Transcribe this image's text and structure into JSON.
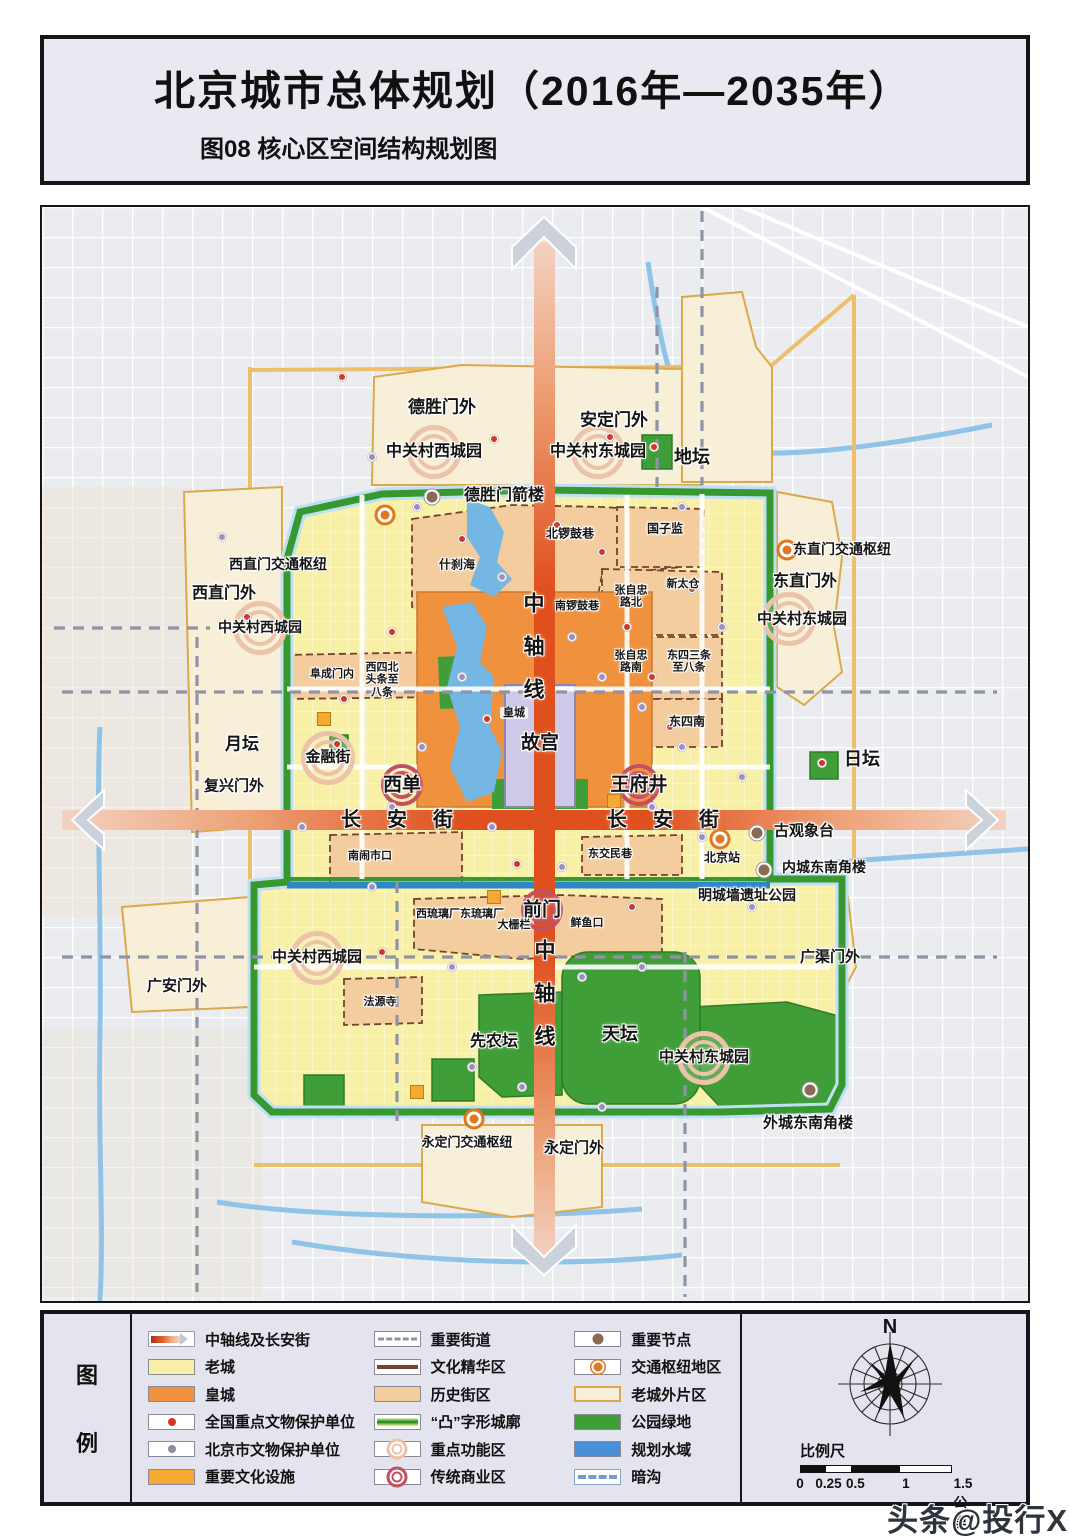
{
  "title": {
    "main": "北京城市总体规划（2016年—2035年）",
    "sub": "图08 核心区空间结构规划图"
  },
  "watermark": "头条@投行X",
  "palette": {
    "axis_road": "#e0501f",
    "old_city": "#f7f0a6",
    "imperial_city": "#ef913d",
    "historic_district": "#f4cd9e",
    "wall_green": "#37982f",
    "park_green": "#3f9e37",
    "water_blue": "#74b6e4",
    "outer_district": "#f8efd8",
    "hub_orange": "#e07820",
    "node_brown": "#8a6a52",
    "commercial_ring": "#c34f63",
    "function_ring": "#ecc3a8",
    "heritage_national": "#d23722",
    "heritage_municipal": "#9c8fbe",
    "facility_amber": "#f5a832"
  },
  "legend": {
    "header_chars": [
      "图",
      "例"
    ],
    "columns": [
      [
        {
          "key": "axis_road",
          "label": "中轴线及长安街"
        },
        {
          "key": "old_city",
          "label": "老城"
        },
        {
          "key": "imperial_city",
          "label": "皇城"
        },
        {
          "key": "national_heritage",
          "label": "全国重点文物保护单位"
        },
        {
          "key": "municipal_heritage",
          "label": "北京市文物保护单位"
        },
        {
          "key": "culture_facility",
          "label": "重要文化设施"
        }
      ],
      [
        {
          "key": "major_street",
          "label": "重要街道"
        },
        {
          "key": "culture_zone",
          "label": "文化精华区"
        },
        {
          "key": "historic_district",
          "label": "历史街区"
        },
        {
          "key": "wall",
          "label": "“凸”字形城廓"
        },
        {
          "key": "function_zone",
          "label": "重点功能区"
        },
        {
          "key": "commercial_zone",
          "label": "传统商业区"
        }
      ],
      [
        {
          "key": "node",
          "label": "重要节点"
        },
        {
          "key": "hub",
          "label": "交通枢纽地区"
        },
        {
          "key": "outer_district",
          "label": "老城外片区"
        },
        {
          "key": "park",
          "label": "公园绿地"
        },
        {
          "key": "water",
          "label": "规划水域"
        },
        {
          "key": "culvert",
          "label": "暗沟"
        }
      ]
    ],
    "compass_n": "N",
    "scale_title": "比例尺",
    "scale_ticks": [
      {
        "t": "0",
        "p": 0
      },
      {
        "t": "0.25",
        "p": 17
      },
      {
        "t": "0.5",
        "p": 33
      },
      {
        "t": "1",
        "p": 63
      },
      {
        "t": "1.5公里",
        "p": 97
      }
    ]
  },
  "map": {
    "labels": [
      {
        "t": "德胜门外",
        "x": 400,
        "y": 200,
        "s": 17
      },
      {
        "t": "安定门外",
        "x": 572,
        "y": 213,
        "s": 17
      },
      {
        "t": "中关村西城园",
        "x": 392,
        "y": 245,
        "s": 16
      },
      {
        "t": "中关村东城园",
        "x": 556,
        "y": 245,
        "s": 16
      },
      {
        "t": "地坛",
        "x": 650,
        "y": 250,
        "s": 18
      },
      {
        "t": "德胜门箭楼",
        "x": 462,
        "y": 289,
        "s": 16
      },
      {
        "t": "东直门交通枢纽",
        "x": 800,
        "y": 343,
        "s": 14
      },
      {
        "t": "西直门交通枢纽",
        "x": 236,
        "y": 358,
        "s": 14
      },
      {
        "t": "东直门外",
        "x": 763,
        "y": 375,
        "s": 16
      },
      {
        "t": "西直门外",
        "x": 182,
        "y": 387,
        "s": 16
      },
      {
        "t": "北锣鼓巷",
        "x": 528,
        "y": 327,
        "s": 12
      },
      {
        "t": "国子监",
        "x": 623,
        "y": 322,
        "s": 12
      },
      {
        "t": "什刹海",
        "x": 415,
        "y": 358,
        "s": 12
      },
      {
        "t": "中关村西城园",
        "x": 218,
        "y": 421,
        "s": 14
      },
      {
        "t": "中关村东城园",
        "x": 760,
        "y": 413,
        "s": 15
      },
      {
        "t": "南锣鼓巷",
        "x": 535,
        "y": 399,
        "s": 11
      },
      {
        "t": "张自忠|路北",
        "x": 589,
        "y": 390,
        "s": 11
      },
      {
        "t": "新太仓",
        "x": 641,
        "y": 377,
        "s": 11
      },
      {
        "t": "张自忠|路南",
        "x": 589,
        "y": 455,
        "s": 11
      },
      {
        "t": "东四三条|至八条",
        "x": 647,
        "y": 455,
        "s": 11
      },
      {
        "t": "阜成门内",
        "x": 290,
        "y": 467,
        "s": 11
      },
      {
        "t": "西四北|头条至|八条",
        "x": 340,
        "y": 473,
        "s": 11
      },
      {
        "t": "皇城",
        "x": 472,
        "y": 506,
        "s": 11,
        "c": "tag"
      },
      {
        "t": "东四南",
        "x": 645,
        "y": 515,
        "s": 12
      },
      {
        "t": "月坛",
        "x": 200,
        "y": 537,
        "s": 17
      },
      {
        "t": "金融街",
        "x": 286,
        "y": 551,
        "s": 15
      },
      {
        "t": "故宫",
        "x": 498,
        "y": 536,
        "s": 19
      },
      {
        "t": "日坛",
        "x": 820,
        "y": 552,
        "s": 18
      },
      {
        "t": "西单",
        "x": 360,
        "y": 578,
        "s": 19
      },
      {
        "t": "王府井",
        "x": 597,
        "y": 578,
        "s": 19
      },
      {
        "t": "复兴门外",
        "x": 192,
        "y": 580,
        "s": 15
      },
      {
        "t": "长安街",
        "x": 368,
        "y": 613,
        "s": 20,
        "ls": 26
      },
      {
        "t": "长安街",
        "x": 634,
        "y": 613,
        "s": 20,
        "ls": 26
      },
      {
        "t": "古观象台",
        "x": 762,
        "y": 625,
        "s": 15
      },
      {
        "t": "东交民巷",
        "x": 568,
        "y": 647,
        "s": 11
      },
      {
        "t": "北京站",
        "x": 680,
        "y": 651,
        "s": 12
      },
      {
        "t": "内城东南角楼",
        "x": 782,
        "y": 661,
        "s": 14
      },
      {
        "t": "南闹市口",
        "x": 328,
        "y": 649,
        "s": 11
      },
      {
        "t": "明城墙遗址公园",
        "x": 705,
        "y": 689,
        "s": 14
      },
      {
        "t": "前门",
        "x": 500,
        "y": 703,
        "s": 19
      },
      {
        "t": "西琉璃厂东琉璃厂",
        "x": 418,
        "y": 707,
        "s": 11
      },
      {
        "t": "大栅栏",
        "x": 472,
        "y": 718,
        "s": 11
      },
      {
        "t": "鲜鱼口",
        "x": 545,
        "y": 716,
        "s": 11
      },
      {
        "t": "中关村西城园",
        "x": 275,
        "y": 751,
        "s": 15
      },
      {
        "t": "广安门外",
        "x": 135,
        "y": 780,
        "s": 15
      },
      {
        "t": "法源寺",
        "x": 338,
        "y": 795,
        "s": 11
      },
      {
        "t": "广渠门外",
        "x": 788,
        "y": 751,
        "s": 15
      },
      {
        "t": "先农坛",
        "x": 452,
        "y": 835,
        "s": 16
      },
      {
        "t": "天坛",
        "x": 578,
        "y": 827,
        "s": 18
      },
      {
        "t": "中关村东城园",
        "x": 662,
        "y": 851,
        "s": 15
      },
      {
        "t": "外城东南角楼",
        "x": 766,
        "y": 917,
        "s": 15
      },
      {
        "t": "永定门交通枢纽",
        "x": 425,
        "y": 936,
        "s": 13
      },
      {
        "t": "永定门外",
        "x": 532,
        "y": 942,
        "s": 15
      },
      {
        "t": "中|轴|线",
        "x": 492,
        "y": 440,
        "s": 21,
        "v": 1
      },
      {
        "t": "中|轴|线",
        "x": 503,
        "y": 787,
        "s": 21,
        "v": 1
      }
    ],
    "markers": [
      {
        "k": "hub",
        "x": 343,
        "y": 308
      },
      {
        "k": "hub",
        "x": 745,
        "y": 343
      },
      {
        "k": "hub",
        "x": 678,
        "y": 632
      },
      {
        "k": "hub",
        "x": 432,
        "y": 912
      },
      {
        "k": "node",
        "x": 390,
        "y": 290
      },
      {
        "k": "node",
        "x": 715,
        "y": 626
      },
      {
        "k": "node",
        "x": 722,
        "y": 663
      },
      {
        "k": "node",
        "x": 768,
        "y": 883
      },
      {
        "k": "comm",
        "x": 360,
        "y": 578
      },
      {
        "k": "comm",
        "x": 597,
        "y": 578
      },
      {
        "k": "comm",
        "x": 500,
        "y": 703
      },
      {
        "k": "func",
        "x": 392,
        "y": 245
      },
      {
        "k": "func",
        "x": 556,
        "y": 245
      },
      {
        "k": "func",
        "x": 286,
        "y": 551
      },
      {
        "k": "func",
        "x": 218,
        "y": 421
      },
      {
        "k": "func",
        "x": 747,
        "y": 412
      },
      {
        "k": "func",
        "x": 275,
        "y": 751
      },
      {
        "k": "func",
        "x": 662,
        "y": 851
      },
      {
        "k": "fac",
        "x": 282,
        "y": 512
      },
      {
        "k": "fac",
        "x": 572,
        "y": 594
      },
      {
        "k": "fac",
        "x": 375,
        "y": 885
      },
      {
        "k": "fac",
        "x": 452,
        "y": 690
      }
    ],
    "dots_red": [
      [
        300,
        170
      ],
      [
        452,
        232
      ],
      [
        612,
        240
      ],
      [
        780,
        556
      ],
      [
        295,
        537
      ],
      [
        350,
        425
      ],
      [
        420,
        332
      ],
      [
        515,
        318
      ],
      [
        560,
        345
      ],
      [
        585,
        420
      ],
      [
        610,
        470
      ],
      [
        650,
        382
      ],
      [
        445,
        512
      ],
      [
        302,
        492
      ],
      [
        475,
        657
      ],
      [
        590,
        700
      ],
      [
        340,
        745
      ],
      [
        628,
        520
      ],
      [
        205,
        410
      ],
      [
        568,
        230
      ]
    ],
    "dots_purple": [
      [
        330,
        250
      ],
      [
        375,
        300
      ],
      [
        460,
        370
      ],
      [
        530,
        430
      ],
      [
        560,
        470
      ],
      [
        600,
        500
      ],
      [
        640,
        540
      ],
      [
        420,
        470
      ],
      [
        380,
        540
      ],
      [
        350,
        600
      ],
      [
        450,
        620
      ],
      [
        520,
        660
      ],
      [
        610,
        600
      ],
      [
        660,
        630
      ],
      [
        700,
        570
      ],
      [
        330,
        680
      ],
      [
        410,
        760
      ],
      [
        540,
        770
      ],
      [
        600,
        760
      ],
      [
        710,
        700
      ],
      [
        260,
        620
      ],
      [
        520,
        240
      ],
      [
        640,
        300
      ],
      [
        680,
        420
      ],
      [
        180,
        330
      ],
      [
        480,
        880
      ],
      [
        560,
        900
      ],
      [
        430,
        860
      ]
    ]
  }
}
